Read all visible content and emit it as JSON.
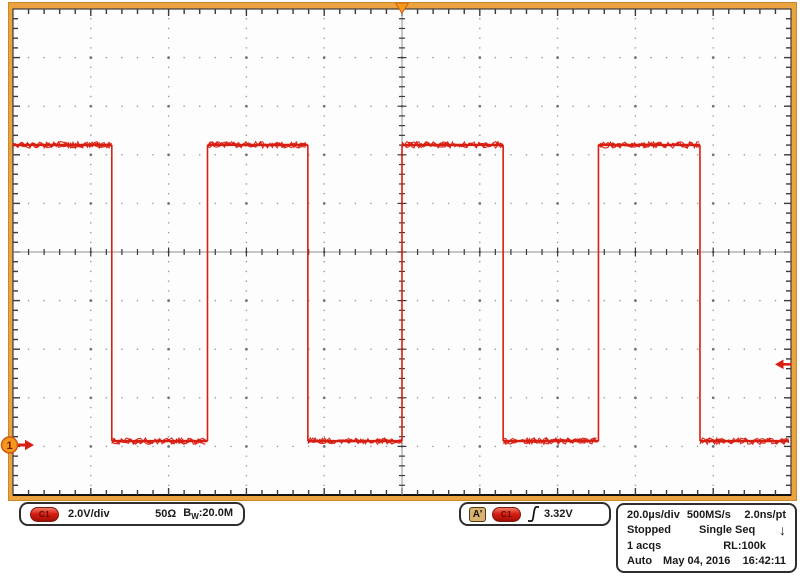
{
  "channel_readout": {
    "channel_badge": "C1",
    "scale": "2.0V/div",
    "impedance": "50Ω",
    "bandwidth_base": "B",
    "bandwidth_sub": "W",
    "bandwidth_value": ":20.0M"
  },
  "trigger_readout": {
    "source_badge": "A'",
    "channel_badge": "C1",
    "level": "3.32V"
  },
  "acq_readout": {
    "timebase": "20.0µs/div",
    "sample_rate": "500MS/s",
    "sample_interval": "2.0ns/pt",
    "run_state": "Stopped",
    "acq_mode": "Single Seq",
    "down_arrow": "↓",
    "acq_count": "1 acqs",
    "record_length": "RL:100k",
    "trigger_mode": "Auto",
    "date": "May 04, 2016",
    "time": "16:42:11"
  },
  "markers": {
    "channel_number": "1"
  },
  "colors": {
    "frame": "#EAA33E",
    "frame_edge": "#3c3c3c",
    "plot_bg": "#FDFDFD",
    "waveform": "#D81E12",
    "grid_dot": "#9A9AA2",
    "grid_dot_major": "#73737B",
    "crosshair": "#8E8E8E",
    "tick": "#3A3A3A",
    "marker_orange": "#F2991C",
    "marker_orange_edge": "#D2530F",
    "marker_red": "#D81E12"
  },
  "chart_data": {
    "type": "line",
    "signal": "square",
    "title": "Channel 1 waveform",
    "volts_per_div": 2.0,
    "time_per_div_us": 20.0,
    "x_range_us": [
      -100,
      100
    ],
    "start_level": "high",
    "edge_times_us": [
      -74.6,
      -50.0,
      -24.2,
      0.0,
      26.0,
      50.5,
      76.6
    ],
    "high_v": 12.35,
    "low_v": 0.16,
    "trigger_level_v": 3.32,
    "channel_zero_marker_v": 0,
    "grid": {
      "h_divisions": 10,
      "v_divisions": 10,
      "minor_per_div": 5
    }
  }
}
